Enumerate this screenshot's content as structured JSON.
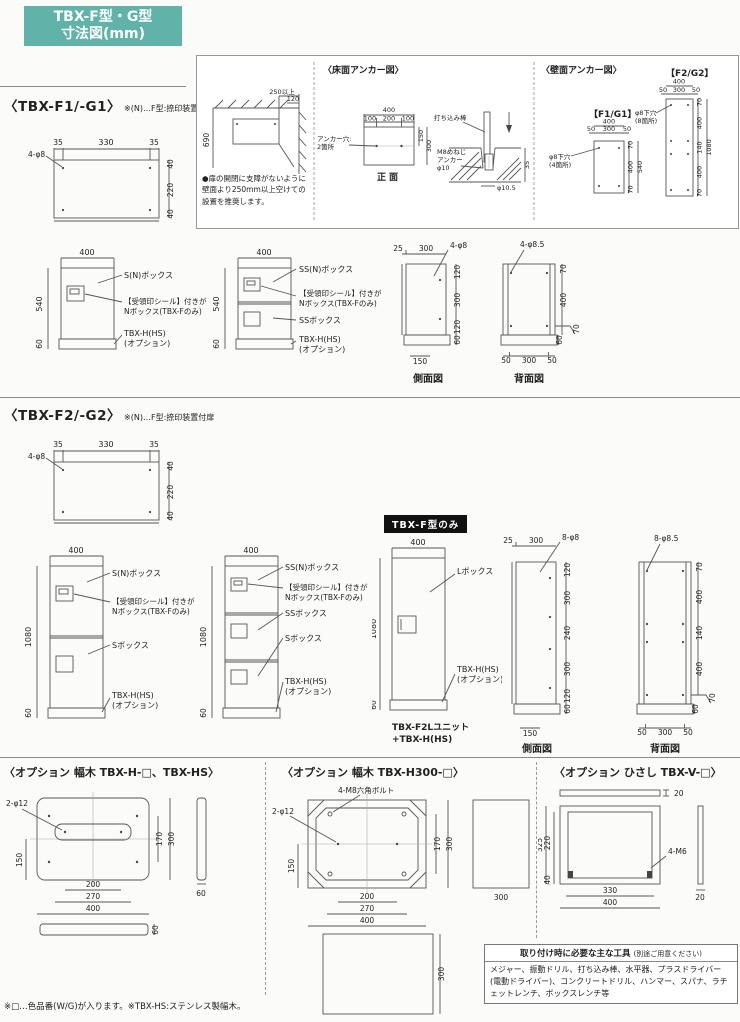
{
  "colors": {
    "accent": "#5fb3a8",
    "badge_bg": "#111111",
    "ink": "#222222",
    "line": "#555555"
  },
  "header": {
    "badge1": "TBX-F型・G型",
    "badge2": "寸法図(mm)"
  },
  "sections": {
    "f1_title": "〈TBX-F1/-G1〉",
    "f2_title": "〈TBX-F2/-G2〉",
    "section_note": "※(N)…F型:捺印装置付扉"
  },
  "anchor_panel": {
    "clearance": {
      "d250": "250以上",
      "d120": "120",
      "d690": "690",
      "note": "●扉の開閉に支障がないように壁面より250mm以上空けての設置を推奨します。"
    },
    "floor": {
      "title": "〈床面アンカー図〉",
      "d400": "400",
      "d100a": "100",
      "d200": "200",
      "d100b": "100",
      "d150": "150",
      "d300": "300",
      "holes1": "アンカー穴:",
      "holes2": "2箇所",
      "caption": "正面",
      "rod": "打ち込み棒",
      "m8_1": "M8めねじ",
      "m8_2": "アンカー",
      "m8_3": "φ10",
      "d35": "35",
      "d105": "φ10.5"
    },
    "wall": {
      "title": "〈壁面アンカー図〉",
      "f1": {
        "tag": "【F1/G1】",
        "d400": "400",
        "d50a": "50",
        "d300": "300",
        "d50b": "50",
        "d70t": "70",
        "d400r": "400",
        "d540": "540",
        "d70b": "70",
        "hole1": "φ8下穴",
        "hole2": "(4箇所)"
      },
      "f2": {
        "tag": "【F2/G2】",
        "d400": "400",
        "d50a": "50",
        "d300": "300",
        "d50b": "50",
        "d70t": "70",
        "d400a": "400",
        "d140": "140",
        "d400b": "400",
        "d1080": "1080",
        "d70b": "70",
        "hole1": "φ8下穴",
        "hole2": "(8箇所)"
      }
    }
  },
  "topview": {
    "d35a": "35",
    "d330": "330",
    "d35b": "35",
    "hole": "4-φ8",
    "d40t": "40",
    "d220": "220",
    "d40b": "40"
  },
  "labels": {
    "s_n": "S(N)ボックス",
    "s": "Sボックス",
    "ss_n": "SS(N)ボックス",
    "ss": "SSボックス",
    "l": "Lボックス",
    "seal1": "【受領印シール】付きが",
    "seal2": "Nボックス(TBX-Fのみ)",
    "opt1": "TBX-H(HS)",
    "opt2": "(オプション)",
    "side_caption": "側面図",
    "back_caption": "背面図",
    "d400": "400",
    "d540": "540",
    "d1080": "1080",
    "d60": "60"
  },
  "f1": {
    "side": {
      "d25": "25",
      "d300": "300",
      "hole": "4-φ8",
      "d120t": "120",
      "d300m": "300",
      "d120b": "120",
      "d150": "150",
      "d60": "60"
    },
    "back": {
      "hole": "4-φ8.5",
      "d70t": "70",
      "d400": "400",
      "d70b": "70",
      "d50a": "50",
      "d300": "300",
      "d50b": "50",
      "d60": "60"
    }
  },
  "f2": {
    "badge": "TBX-F型のみ",
    "unit_cap1": "TBX-F2Lユニット",
    "unit_cap2": "+TBX-H(HS)",
    "side": {
      "d25": "25",
      "d300": "300",
      "hole": "8-φ8",
      "d120t": "120",
      "d300a": "300",
      "d240": "240",
      "d300b": "300",
      "d120b": "120",
      "d150": "150",
      "d60": "60"
    },
    "back": {
      "hole": "8-φ8.5",
      "d70t": "70",
      "d400a": "400",
      "d140": "140",
      "d400b": "400",
      "d70b": "70",
      "d50a": "50",
      "d300": "300",
      "d50b": "50",
      "d60": "60"
    }
  },
  "options": {
    "o1": {
      "title": "〈オプション 幅木 TBX-H-□、TBX-HS〉",
      "hole": "2-φ12",
      "d150": "150",
      "d170": "170",
      "d300": "300",
      "d200": "200",
      "d270": "270",
      "d400": "400",
      "d60side": "60",
      "d60front": "60"
    },
    "o2": {
      "title": "〈オプション 幅木 TBX-H300-□〉",
      "bolt": "4-M8六角ボルト",
      "hole": "2-φ12",
      "d150": "150",
      "d170": "170",
      "d300": "300",
      "d200": "200",
      "d270": "270",
      "d400": "400",
      "d300side": "300",
      "d300front": "300"
    },
    "o3": {
      "title": "〈オプション ひさし TBX-V-□〉",
      "d20top": "20",
      "d325": "325",
      "d220": "220",
      "d40": "40",
      "bolt": "4-M6",
      "d330": "330",
      "d400": "400",
      "d20side": "20"
    }
  },
  "tools": {
    "title": "取り付け時に必要な主な工具",
    "title_note": "(別途ご用意ください)",
    "body": "メジャー、振動ドリル、打ち込み棒、水平器、プラスドライバー(電動ドライバー)、コンクリートドリル、ハンマー、スパナ、ラチェットレンチ、ボックスレンチ等"
  },
  "footnote": "※□…色品番(W/G)が入ります。※TBX-HS:ステンレス製幅木。"
}
